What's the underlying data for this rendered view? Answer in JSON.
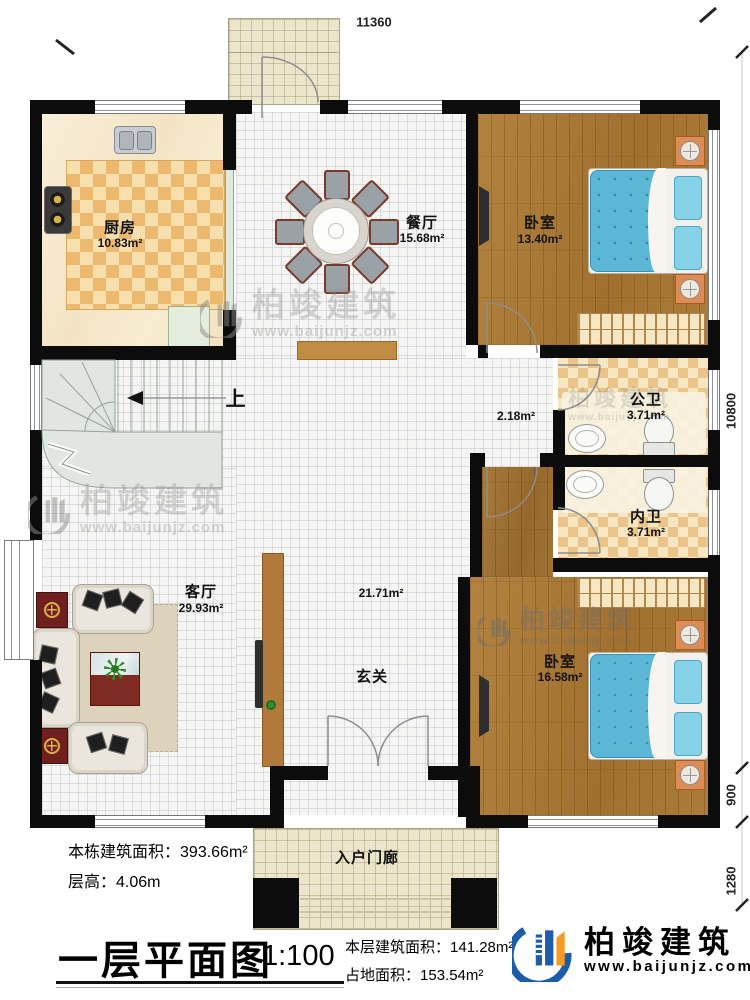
{
  "plan": {
    "dimensions": {
      "top": "11360",
      "right_total": "10800",
      "right_upper": "900",
      "right_lower": "1280"
    },
    "rooms": [
      {
        "name": "厨房",
        "area": "10.83m²"
      },
      {
        "name": "餐厅",
        "area": "15.68m²"
      },
      {
        "name": "卧室",
        "area": "13.40m²"
      },
      {
        "name": "公卫",
        "area": "3.71m²"
      },
      {
        "name": "内卫",
        "area": "3.71m²"
      },
      {
        "name": "卧室",
        "area": "16.58m²"
      },
      {
        "name": "客厅",
        "area": "29.93m²"
      },
      {
        "name": "玄关",
        "area": "21.71m²"
      },
      {
        "area": "2.18m²"
      },
      {
        "name": "入户门廊"
      }
    ],
    "stairs_up_label": "上"
  },
  "title_block": {
    "rows_left": [
      {
        "label": "本栋建筑面积：",
        "value": "393.66m²"
      },
      {
        "label": "层高：",
        "value": "4.06m"
      }
    ],
    "plan_title": "一层平面图",
    "scale": "1:100",
    "rows_right": [
      {
        "label": "本层建筑面积：",
        "value": "141.28m²"
      },
      {
        "label": "占地面积：",
        "value": "153.54m²"
      }
    ]
  },
  "brand": {
    "name": "柏竣建筑",
    "url": "www.baijunjz.com"
  },
  "watermark": {
    "name": "柏竣建筑",
    "url": "www.baijunjz.com"
  },
  "colors": {
    "wall": "#0c0c0c",
    "bed": "#5cb6d6",
    "brand_blue": "#1c5ca8",
    "brand_orange": "#f59a23"
  }
}
